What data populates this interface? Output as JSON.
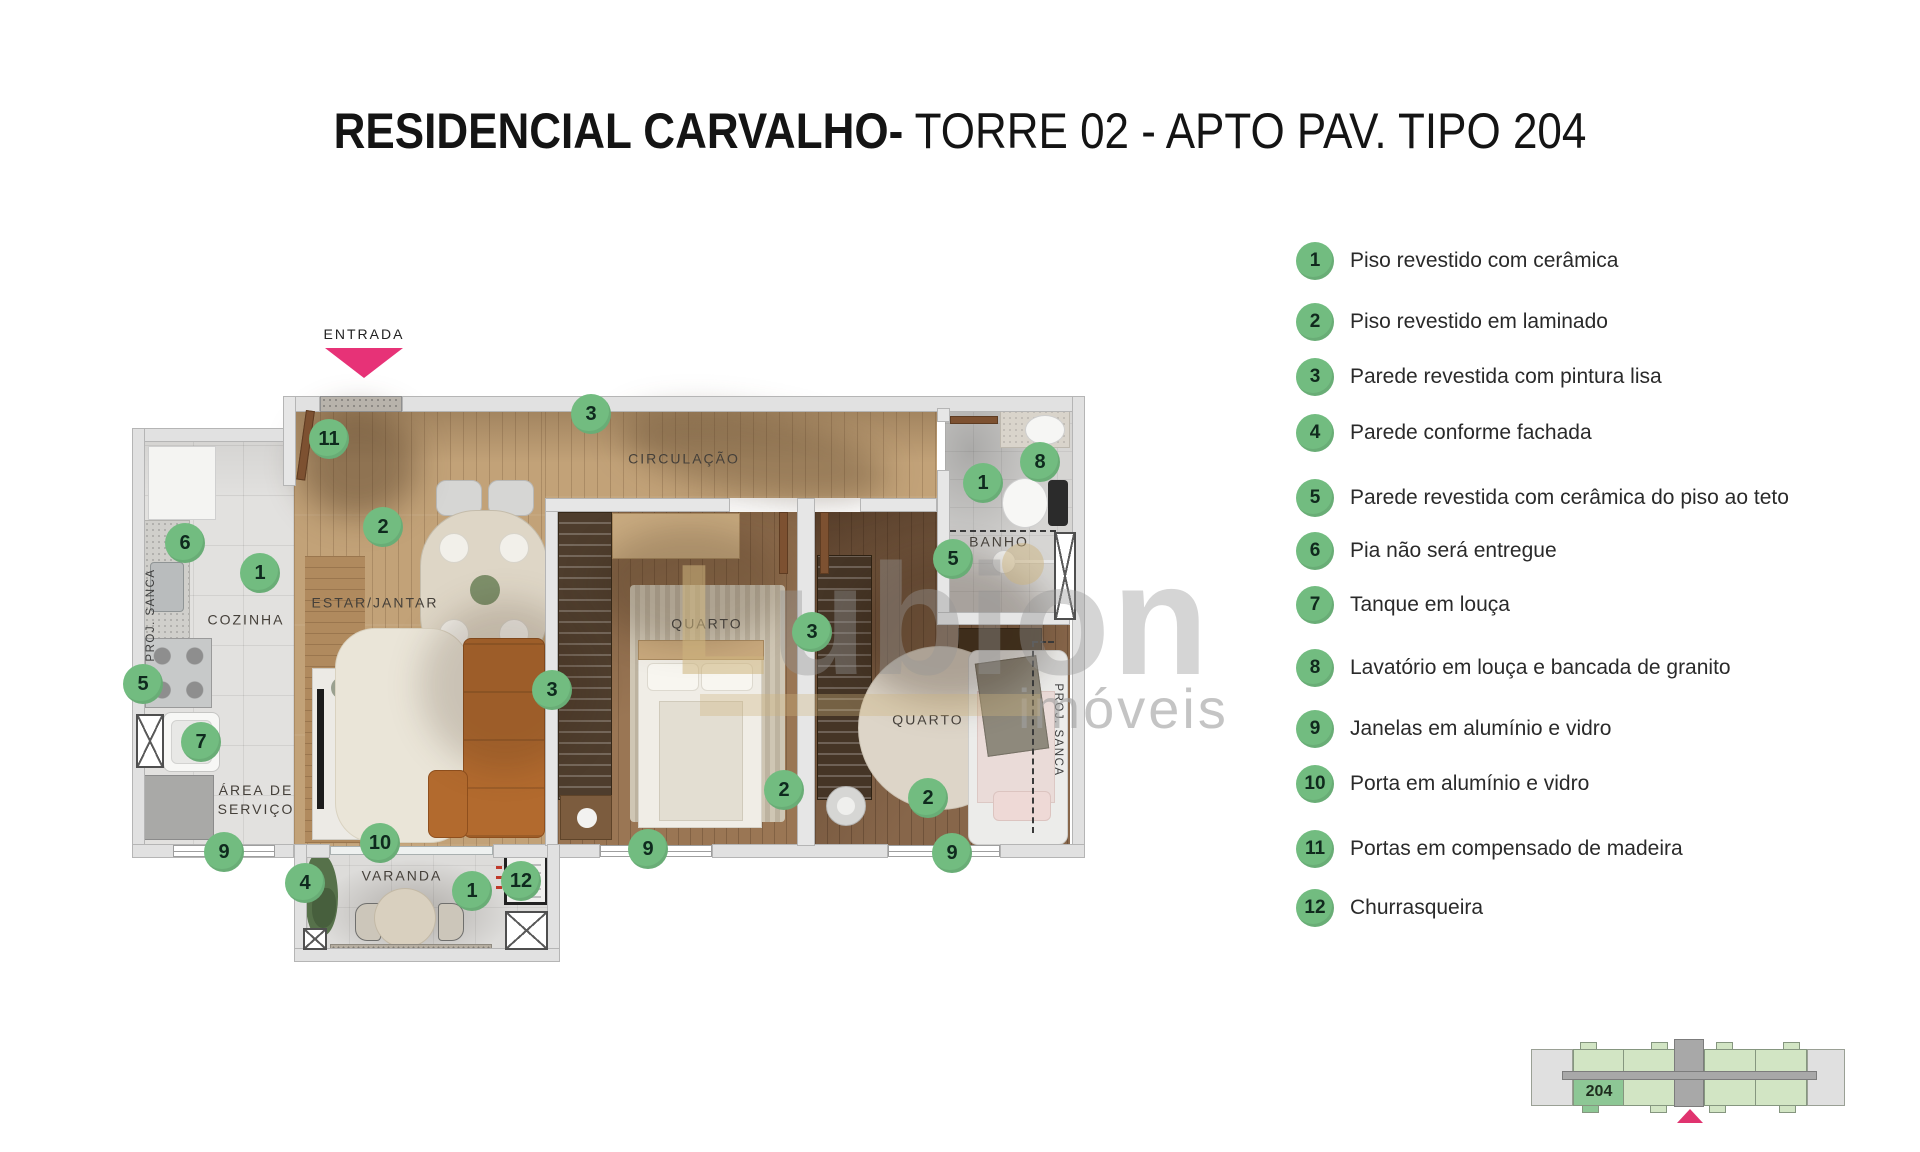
{
  "title": {
    "bold": "RESIDENCIAL CARVALHO-",
    "regular": " TORRE 02 - APTO PAV. TIPO 204"
  },
  "entrance": {
    "label": "ENTRADA"
  },
  "watermark": {
    "big_first": "L",
    "big_rest": "ubion",
    "small": "imóveis"
  },
  "legend": {
    "items": [
      {
        "num": "1",
        "text": "Piso revestido com cerâmica"
      },
      {
        "num": "2",
        "text": "Piso revestido em laminado"
      },
      {
        "num": "3",
        "text": "Parede revestida com pintura lisa"
      },
      {
        "num": "4",
        "text": "Parede conforme fachada"
      },
      {
        "num": "5",
        "text": "Parede revestida com cerâmica do piso ao teto"
      },
      {
        "num": "6",
        "text": "Pia não será entregue"
      },
      {
        "num": "7",
        "text": "Tanque em louça"
      },
      {
        "num": "8",
        "text": "Lavatório em louça e bancada de granito"
      },
      {
        "num": "9",
        "text": "Janelas em alumínio e vidro"
      },
      {
        "num": "10",
        "text": "Porta em alumínio e vidro"
      },
      {
        "num": "11",
        "text": "Portas em compensado de madeira"
      },
      {
        "num": "12",
        "text": "Churrasqueira"
      }
    ],
    "ys": [
      261,
      322,
      377,
      433,
      498,
      551,
      605,
      668,
      729,
      784,
      849,
      908
    ]
  },
  "plan": {
    "proj_sanca": "PROJ. SANCA",
    "room_labels": [
      {
        "id": "cozinha",
        "text": "COZINHA",
        "x": 246,
        "y": 620
      },
      {
        "id": "estar-jantar",
        "text": "ESTAR/JANTAR",
        "x": 375,
        "y": 603
      },
      {
        "id": "circulacao",
        "text": "CIRCULAÇÃO",
        "x": 684,
        "y": 459
      },
      {
        "id": "quarto-1",
        "text": "QUARTO",
        "x": 707,
        "y": 624
      },
      {
        "id": "quarto-2",
        "text": "QUARTO",
        "x": 928,
        "y": 720
      },
      {
        "id": "banho",
        "text": "BANHO",
        "x": 999,
        "y": 542
      },
      {
        "id": "varanda",
        "text": "VARANDA",
        "x": 402,
        "y": 876
      },
      {
        "id": "area-servico",
        "text": "ÁREA DE\nSERVIÇO",
        "x": 256,
        "y": 800
      }
    ],
    "badges": [
      {
        "num": "11",
        "x": 329,
        "y": 439
      },
      {
        "num": "3",
        "x": 591,
        "y": 414
      },
      {
        "num": "6",
        "x": 185,
        "y": 543
      },
      {
        "num": "2",
        "x": 383,
        "y": 527
      },
      {
        "num": "1",
        "x": 260,
        "y": 573
      },
      {
        "num": "8",
        "x": 1040,
        "y": 462
      },
      {
        "num": "1",
        "x": 983,
        "y": 483
      },
      {
        "num": "5",
        "x": 953,
        "y": 559
      },
      {
        "num": "3",
        "x": 552,
        "y": 690
      },
      {
        "num": "3",
        "x": 812,
        "y": 632
      },
      {
        "num": "5",
        "x": 143,
        "y": 684
      },
      {
        "num": "7",
        "x": 201,
        "y": 742
      },
      {
        "num": "2",
        "x": 784,
        "y": 790
      },
      {
        "num": "2",
        "x": 928,
        "y": 798
      },
      {
        "num": "9",
        "x": 224,
        "y": 852
      },
      {
        "num": "9",
        "x": 648,
        "y": 849
      },
      {
        "num": "9",
        "x": 952,
        "y": 853
      },
      {
        "num": "4",
        "x": 305,
        "y": 883
      },
      {
        "num": "10",
        "x": 380,
        "y": 843
      },
      {
        "num": "1",
        "x": 472,
        "y": 891
      },
      {
        "num": "12",
        "x": 521,
        "y": 881
      }
    ]
  },
  "keyplan": {
    "unit_label": "204"
  },
  "colors": {
    "accent_pink": "#e73277",
    "badge_green": "#72bc80",
    "keyplan_cell_green": "#d2e5c4",
    "keyplan_highlight_green": "#8dc795",
    "keyplan_gray": "#a8a8a8",
    "keyplan_cap_gray": "#e0e0e0"
  }
}
